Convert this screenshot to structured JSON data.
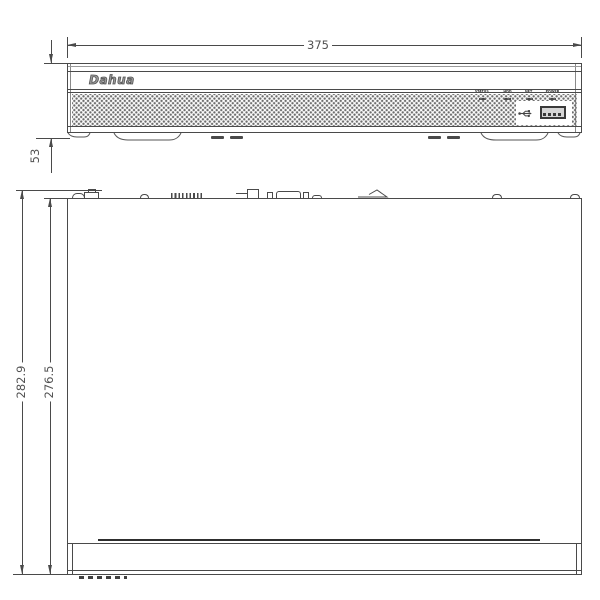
{
  "title": "NVR front and top view dimension drawing",
  "dimensions": {
    "width": "375",
    "height": "53",
    "depth_outer": "282.9",
    "depth_inner": "276.5"
  },
  "front_view": {
    "logo_text": "Dahua",
    "led_labels": [
      "STATUS",
      "HDD",
      "NET",
      "POWER"
    ],
    "icons": {
      "usb": "usb-trident-icon"
    }
  },
  "top_view": {
    "rear_connectors": [
      "power-socket",
      "screw",
      "vent-slots",
      "connector-block",
      "small-port",
      "vga-port",
      "small-port",
      "bracket-wedge",
      "screw",
      "screw"
    ]
  },
  "colors": {
    "line": "#4a4a4a",
    "text": "#525252",
    "background": "#ffffff"
  }
}
